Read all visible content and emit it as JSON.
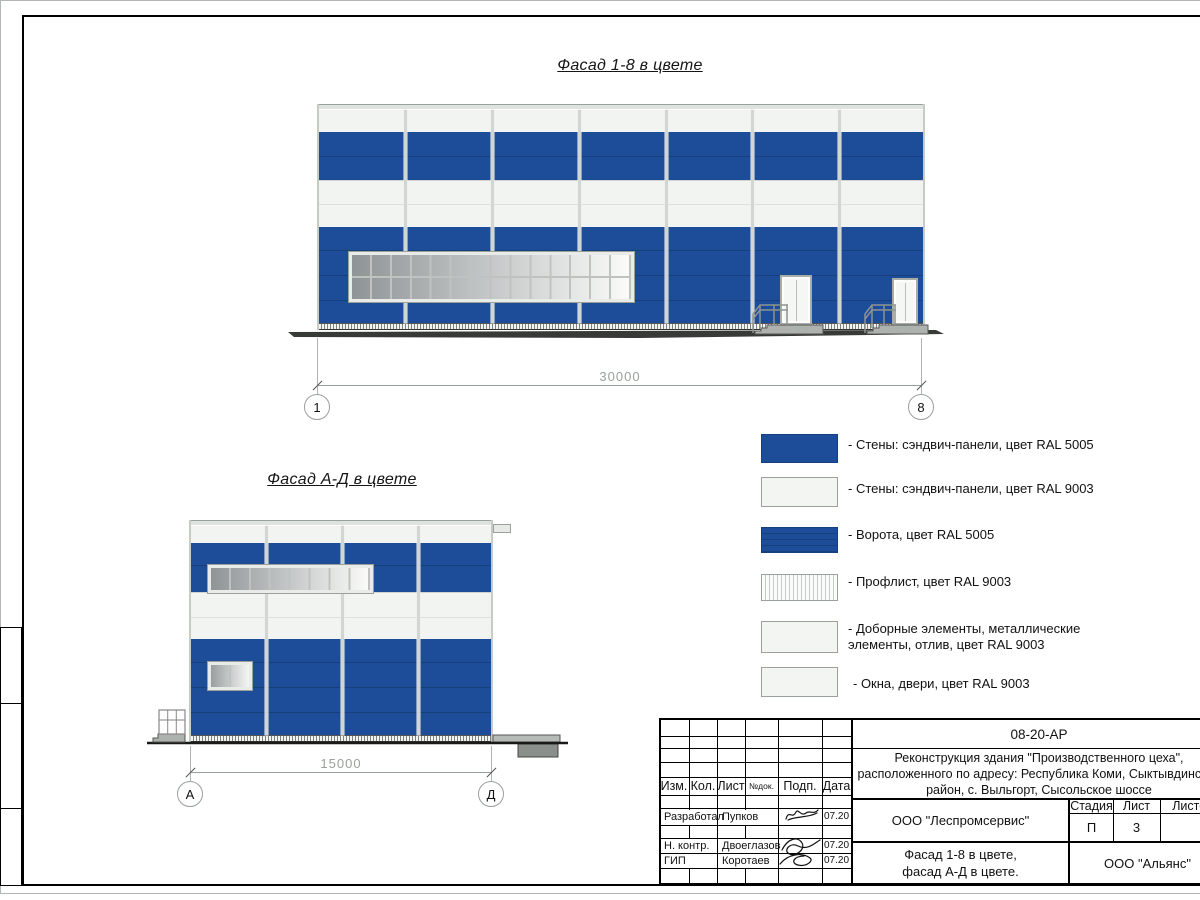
{
  "titles": {
    "facade_1_8": "Фасад 1-8 в цвете",
    "facade_a_d": "Фасад А-Д в цвете"
  },
  "dimensions": {
    "facade_1_8": {
      "length": "30000",
      "axis_start": "1",
      "axis_end": "8"
    },
    "facade_a_d": {
      "length": "15000",
      "axis_start": "А",
      "axis_end": "Д"
    }
  },
  "legend": {
    "items": [
      {
        "label": "- Стены: сэндвич-панели, цвет RAL 5005"
      },
      {
        "label": "- Стены: сэндвич-панели, цвет RAL 9003"
      },
      {
        "label": "- Ворота, цвет RAL 5005"
      },
      {
        "label": "- Профлист, цвет RAL 9003"
      },
      {
        "label": "- Доборные элементы, металлические",
        "label2": "элементы, отлив, цвет RAL 9003"
      },
      {
        "label": "- Окна, двери, цвет RAL 9003"
      }
    ]
  },
  "titleblock": {
    "doc_code": "08-20-АР",
    "project_line1": "Реконструкция здания \"Производственного цеха\",",
    "project_line2": "расположенного по адресу: Республика Коми, Сыктывдинский",
    "project_line3": "район, с. Выльгорт, Сысольское шоссе",
    "cols": {
      "izm": "Изм.",
      "kol": "Кол.",
      "list": "Лист",
      "ndok": "№док.",
      "podp": "Подп.",
      "data": "Дата"
    },
    "stage_col": "Стадия",
    "list_col": "Лист",
    "listov_col": "Листов",
    "stage_value": "П",
    "list_value": "3",
    "org_design": "ООО \"Леспромсервис\"",
    "org_customer": "ООО \"Альянс\"",
    "sheet_name_line1": "Фасад 1-8 в цвете,",
    "sheet_name_line2": "фасад А-Д в цвете.",
    "rows": [
      {
        "role": "Разработал",
        "name": "Пупков",
        "date": "07.20"
      },
      {
        "role": "Н. контр.",
        "name": "Двоеглазов",
        "date": "07.20"
      },
      {
        "role": "ГИП",
        "name": "Коротаев",
        "date": "07.20"
      }
    ]
  },
  "colors": {
    "wall_blue_ral5005": "#1d4c98",
    "panel_joint_blue": "#163f7e",
    "wall_white_ral9003": "#f2f4f1",
    "mullion_gray": "#d2d6d2"
  }
}
